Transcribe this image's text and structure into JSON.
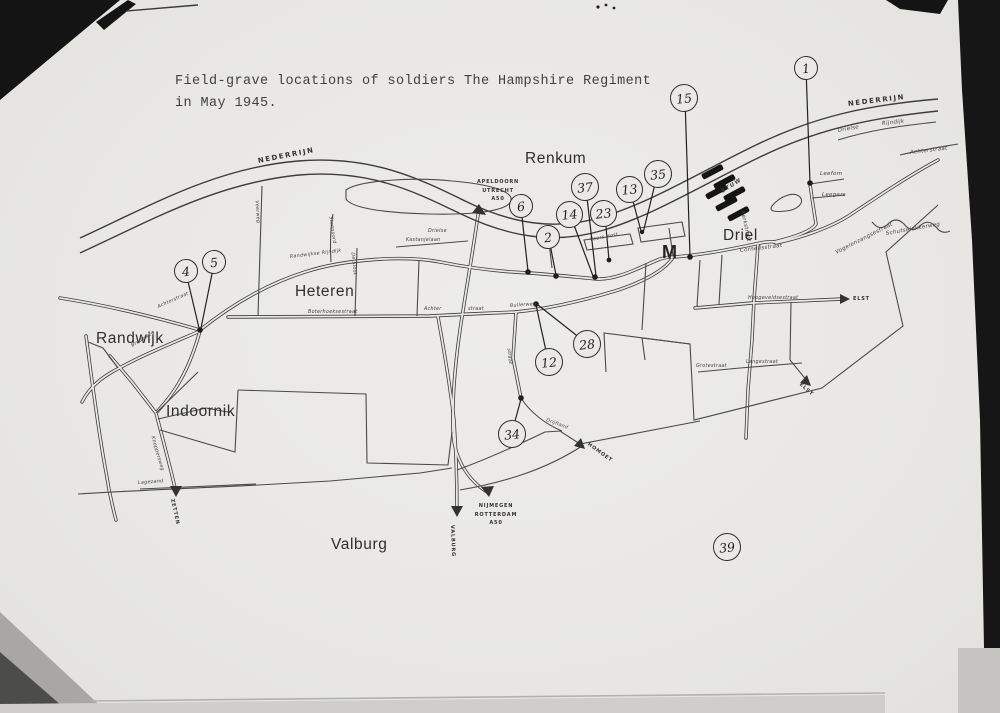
{
  "title": {
    "line1": "Field-grave locations of soldiers The Hampshire Regiment",
    "line2": "in May 1945."
  },
  "map": {
    "towns": [
      "Renkum",
      "Driel",
      "Heteren",
      "Randwijk",
      "Indoornik",
      "Valburg"
    ],
    "landmark_letter": "M",
    "river_name": "NEDERRIJN",
    "weir_label": "STUW",
    "markers": [
      "1",
      "15",
      "35",
      "13",
      "37",
      "6",
      "14",
      "23",
      "2",
      "4",
      "5",
      "12",
      "28",
      "34",
      "39"
    ],
    "signs": {
      "apeldoorn": [
        "APELDOORN",
        "UTRECHT",
        "A50"
      ],
      "nijmegen": [
        "NIJMEGEN",
        "ROTTERDAM",
        "A50"
      ],
      "valburg": "VALBURG",
      "zetten": "ZETTEN",
      "elst": "ELST",
      "homoet": "HOMOET"
    },
    "street_labels": [
      "Drielse",
      "Rijndijk",
      "Achterstraat",
      "Leefom",
      "Leegers",
      "Vogelenzangsestraat",
      "Schutselakkerweg",
      "Cornelisstraat",
      "Kerkstraat",
      "Hoogeveldsestraat",
      "Langestraat",
      "Grotestraat",
      "Boterhoeksestraat",
      "Achter",
      "straat",
      "Bullerweg",
      "Randwijkse Rijndijk",
      "Drielse",
      "Kastanjelaan",
      "Steenoord",
      "De Sloot",
      "Veerweg",
      "Achterstraat",
      "Bredeweg",
      "Knoppersweg",
      "Lagezand",
      "Veers Host",
      "Drijfland",
      "straat"
    ],
    "ink_color": "#3a3a3a",
    "paper_color": "#e9e8e5"
  }
}
